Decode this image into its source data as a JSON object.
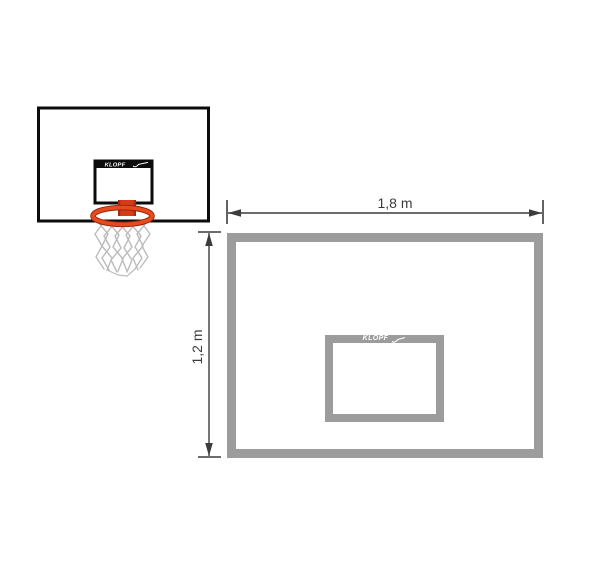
{
  "page": {
    "background_color": "#ffffff"
  },
  "product_illustration": {
    "description": "basketball backboard with shooting square, orange rim and white net",
    "brand_logo_text": "KLOPF",
    "colors": {
      "board_outline": "#0c0c0c",
      "logo_text": "#ffffff",
      "rim_red": "#e64a1e",
      "rim_shadow": "#99260c",
      "net_gray": "#bcbcbc",
      "bolt_teal": "#3f97a8"
    }
  },
  "dimension_diagram": {
    "brand_logo_text": "KLOPF",
    "width_dimension_label": "1,8 m",
    "height_dimension_label": "1,2 m",
    "colors": {
      "board_outline_gray": "#9c9c9c",
      "dimension_line": "#3c3c3c",
      "label_text": "#3b3b3b",
      "logo_text": "#ffffff"
    }
  }
}
